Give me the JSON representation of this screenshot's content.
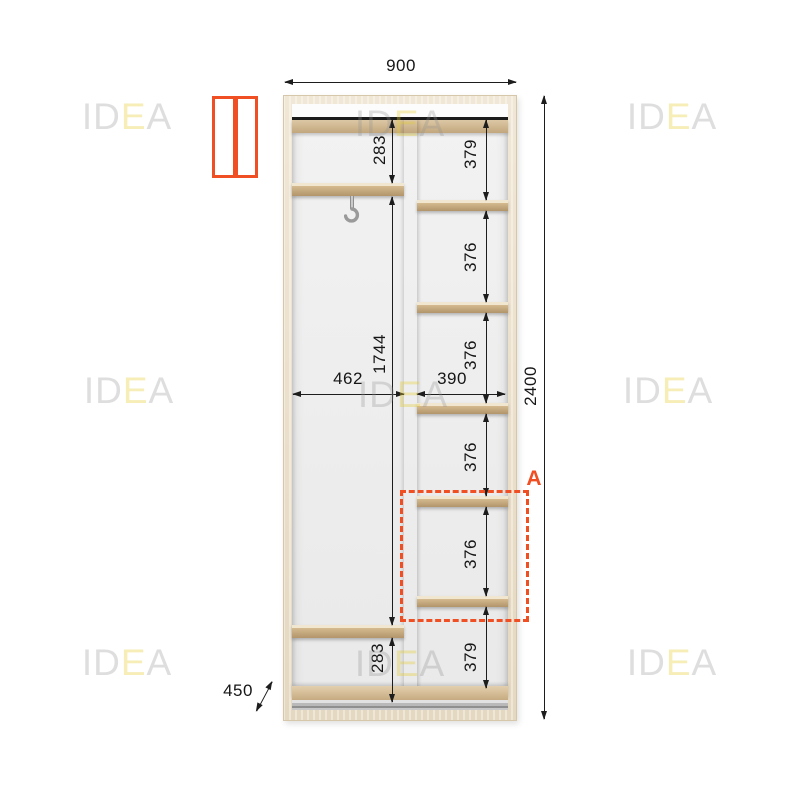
{
  "watermark": {
    "gray1": "ID",
    "accent": "E",
    "gray2": "A"
  },
  "colors": {
    "accent_orange": "#f04e23",
    "dimension_ink": "#1d1d1d",
    "frame_wood": "#ecdfc9",
    "shelf_wood": "#d5ba90",
    "watermark_gray": "#e3e3e3",
    "watermark_yellow": "#f6efc2"
  },
  "dims": {
    "overall_width": "900",
    "overall_height": "2400",
    "overall_depth": "450",
    "left_top_gap": "283",
    "left_middle_gap": "1744",
    "left_bottom_gap": "283",
    "left_inner_width": "462",
    "right_inner_width": "390",
    "right_gaps": [
      "379",
      "376",
      "376",
      "376",
      "376",
      "379"
    ],
    "section_label": "A"
  }
}
